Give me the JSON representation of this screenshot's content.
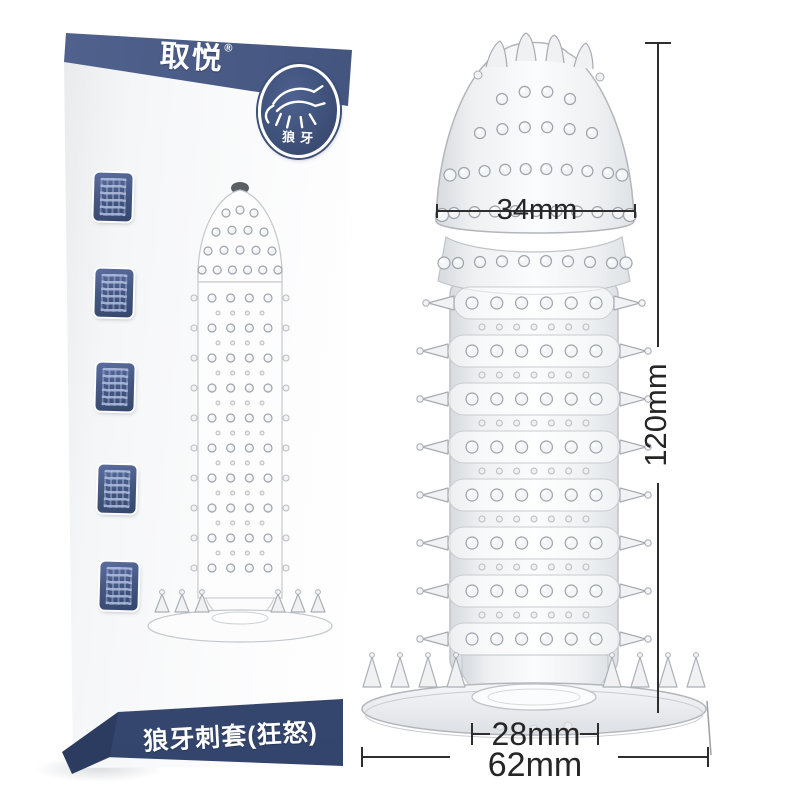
{
  "package_box": {
    "brand_logo": "取悦",
    "registered_mark": "®",
    "badge_label": "狼牙",
    "bottom_band_label": "狼牙刺套(狂怒)"
  },
  "product_annotations": {
    "head_width": "34mm",
    "total_length": "120mm",
    "inner_width": "28mm",
    "base_width": "62mm"
  },
  "colors": {
    "box_navy": "#3e5179",
    "box_navy_dark": "#2c3c60",
    "dimension_line": "#2e2e2e",
    "product_gray": "#d9dcdf",
    "background": "#ffffff"
  }
}
